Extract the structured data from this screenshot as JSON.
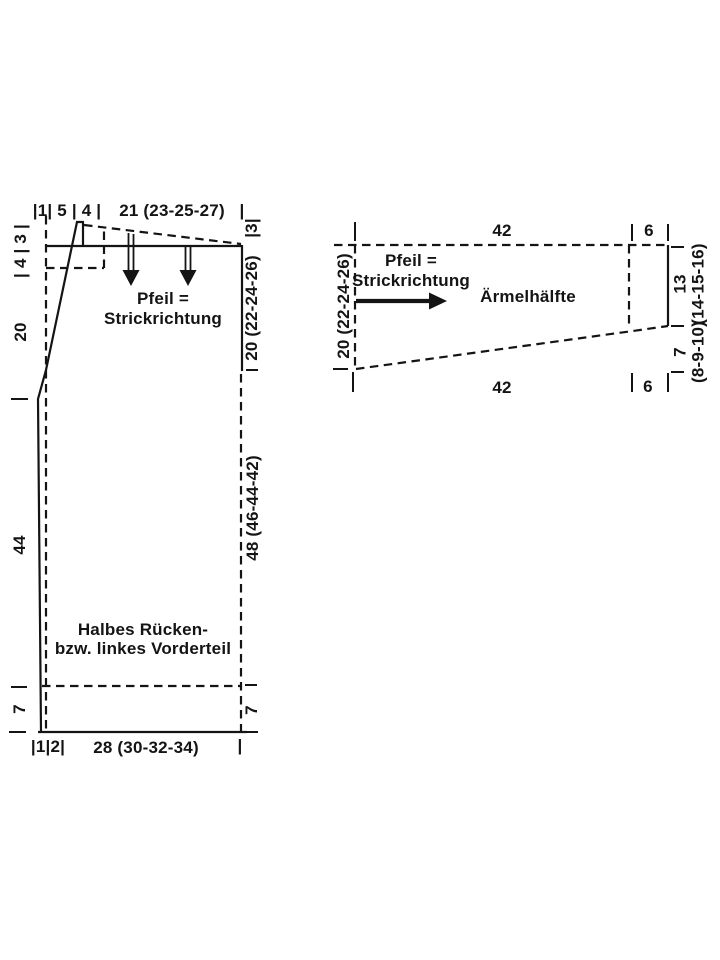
{
  "canvas": {
    "background": "#ffffff",
    "ink": "#141414"
  },
  "back_piece": {
    "top_edge": {
      "segments": "|1| 5 | 4 |",
      "width": "21 (23-25-27)",
      "end_tick": "|"
    },
    "left_edge": {
      "shoulder_steps": "| 4 | 3 |",
      "armhole_depth": "20",
      "body_length": "44",
      "hem_depth": "7"
    },
    "right_edge": {
      "shoulder_drop": "|3|",
      "upper_length": "20 (22-24-26)",
      "lower_length": "48 (46-44-42)",
      "hem_depth": "7"
    },
    "bottom_edge": {
      "segments": "|1|2|",
      "width": "28 (30-32-34)",
      "end_tick": "|"
    },
    "direction_note": {
      "line1": "Pfeil =",
      "line2": "Strickrichtung"
    },
    "caption": {
      "line1": "Halbes Rücken-",
      "line2": "bzw. linkes Vorderteil"
    }
  },
  "sleeve_piece": {
    "caption": "Ärmelhälfte",
    "direction_note": {
      "line1": "Pfeil =",
      "line2": "Strickrichtung"
    },
    "top_edge": {
      "width": "42",
      "cap_width": "6"
    },
    "bottom_edge": {
      "width": "42",
      "cap_width": "6"
    },
    "left_edge": {
      "height": "20 (22-24-26)"
    },
    "right_edge": {
      "upper_value": "13",
      "upper_sizes": "(14-15-16)",
      "lower_value": "7",
      "lower_sizes": "(8-9-10)"
    }
  }
}
